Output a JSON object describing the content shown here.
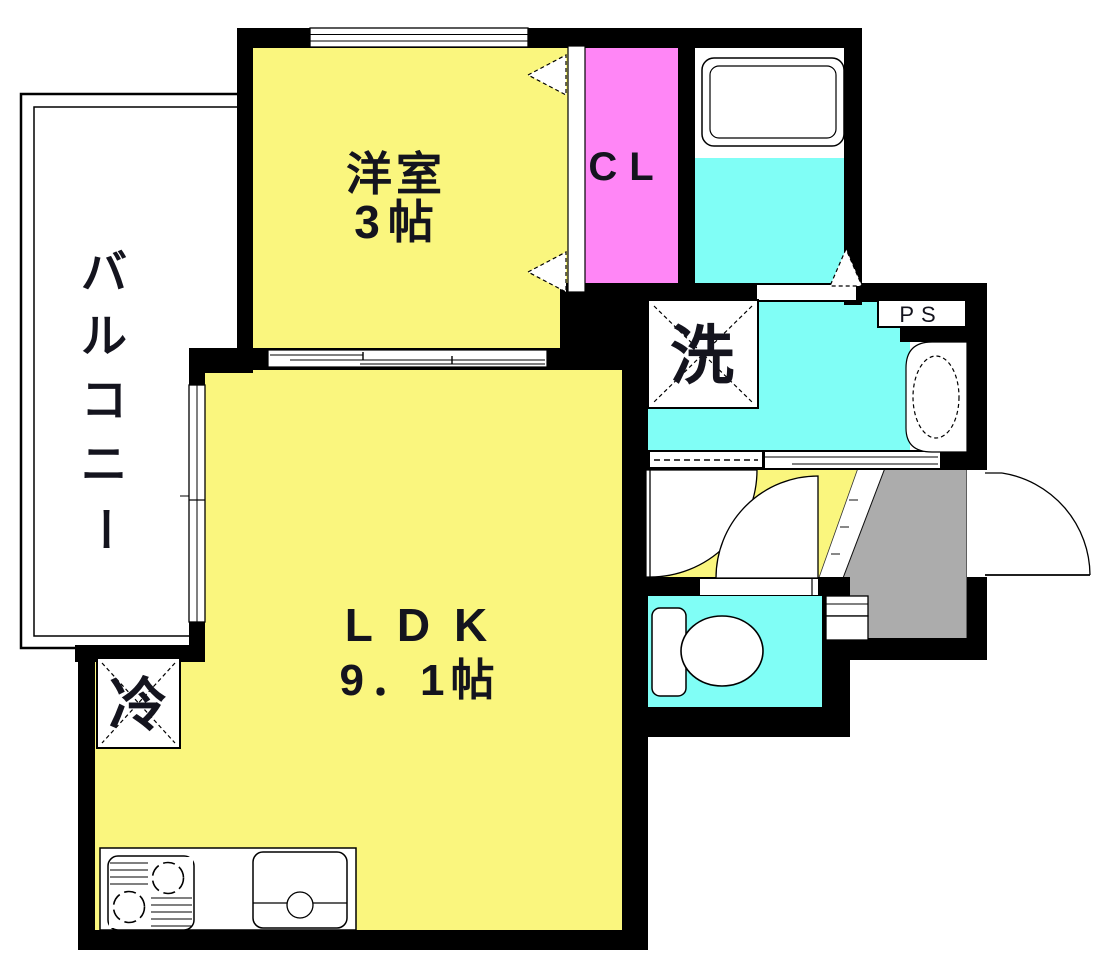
{
  "rooms": {
    "balcony": {
      "label": "バルコニー",
      "chars": [
        "バ",
        "ル",
        "コ",
        "ニ",
        "ー"
      ]
    },
    "western_room": {
      "label": "洋室",
      "size": "3帖"
    },
    "closet": {
      "label": "CL"
    },
    "ldk": {
      "label": "LDK",
      "size": "9．1帖"
    },
    "laundry": {
      "label": "洗"
    },
    "pipe_space": {
      "label": "PS"
    },
    "refrigerator": {
      "label": "冷"
    }
  },
  "colors": {
    "floor_yellow": "#FAF67E",
    "wet_cyan": "#80FEF6",
    "closet_pink": "#FF86F6",
    "entrance_gray": "#ACACAC",
    "wall_black": "#000000"
  }
}
